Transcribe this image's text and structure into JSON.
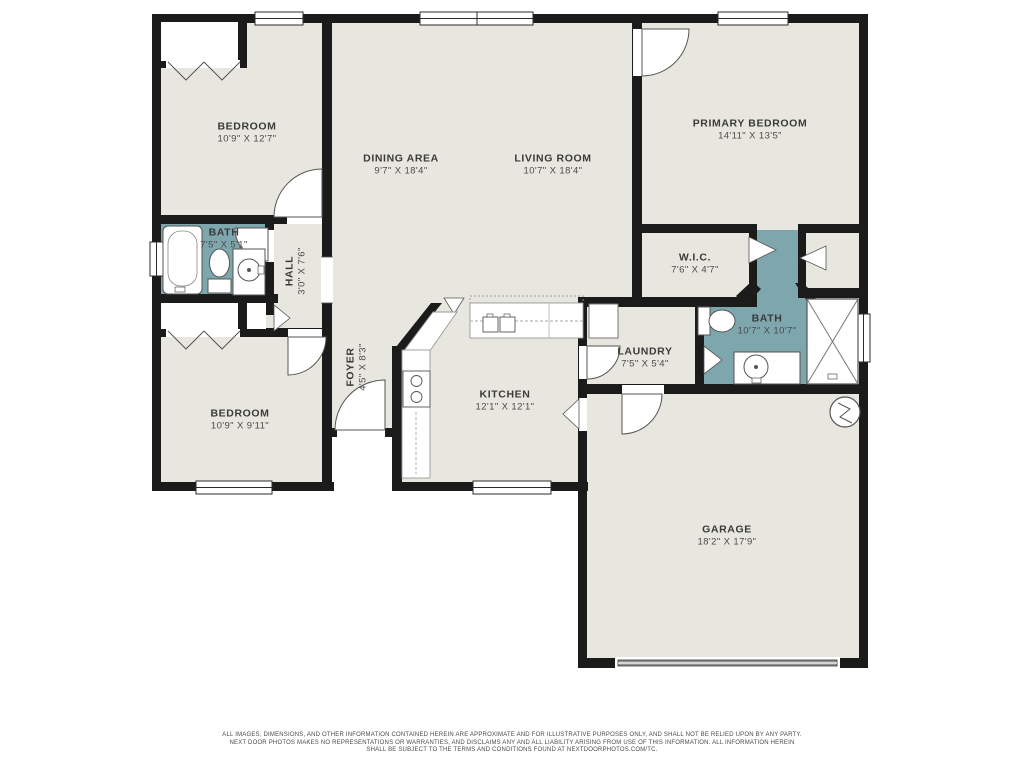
{
  "palette": {
    "floor": "#e8e7df",
    "bath_floor": "#7ea6ad",
    "wall": "#1b1b1b",
    "fixture_stroke": "#555555",
    "garage_door_gray": "#8f8f8f",
    "label_text": "#3a3a3a",
    "disclaimer_text": "#4a4a4a"
  },
  "rooms": [
    {
      "name": "BEDROOM",
      "dims": "10'9\" X 12'7\""
    },
    {
      "name": "DINING AREA",
      "dims": "9'7\" X 18'4\""
    },
    {
      "name": "LIVING ROOM",
      "dims": "10'7\" X 18'4\""
    },
    {
      "name": "PRIMARY BEDROOM",
      "dims": "14'11\" X 13'5\""
    },
    {
      "name": "BATH",
      "dims": "7'5\" X 5'1\""
    },
    {
      "name": "HALL",
      "dims": "3'0\" X 7'6\""
    },
    {
      "name": "W.I.C.",
      "dims": "7'6\" X 4'7\""
    },
    {
      "name": "BATH",
      "dims": "10'7\" X 10'7\""
    },
    {
      "name": "LAUNDRY",
      "dims": "7'5\" X 5'4\""
    },
    {
      "name": "KITCHEN",
      "dims": "12'1\" X 12'1\""
    },
    {
      "name": "FOYER",
      "dims": "4'5\" X 8'3\""
    },
    {
      "name": "BEDROOM",
      "dims": "10'9\" X 9'11\""
    },
    {
      "name": "GARAGE",
      "dims": "18'2\" X 17'9\""
    }
  ],
  "icons": {
    "window": "double-line-rect",
    "door-swing": "white-quarter-arc",
    "opening-wedge": "white-triangle-notch",
    "bifold-closet-door": "chevron-v-lines",
    "bathtub": "rounded-rect-with-inner-oval",
    "toilet": "ellipse-with-tank",
    "sink-vanity": "circle-in-rect",
    "shower": "x-crossed-square",
    "kitchen-range": "rect-with-burner-circles",
    "kitchen-island-sink": "double-basin-rects",
    "laundry-appliance": "outlined-square",
    "water-heater": "circle-with-zigzag",
    "garage-door": "gray-bar"
  },
  "disclaimer": {
    "lines": [
      "ALL IMAGES, DIMENSIONS, AND OTHER INFORMATION CONTAINED HEREIN ARE APPROXIMATE AND FOR ILLUSTRATIVE PURPOSES ONLY, AND SHALL NOT BE RELIED UPON BY ANY PARTY.",
      "NEXT DOOR PHOTOS MAKES NO REPRESENTATIONS OR WARRANTIES, AND DISCLAIMS ANY AND ALL LIABILITY ARISING FROM USE OF THIS INFORMATION. ALL INFORMATION HEREIN",
      "SHALL BE SUBJECT TO THE TERMS AND CONDITIONS FOUND AT NEXTDOORPHOTOS.COM/TC."
    ]
  }
}
